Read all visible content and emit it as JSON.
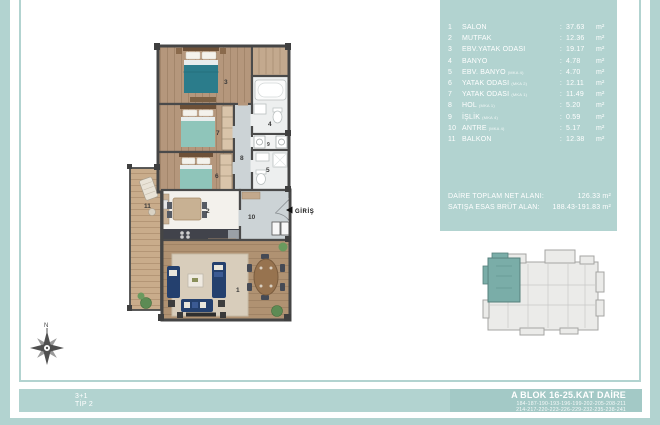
{
  "legend": {
    "separator": ":",
    "items": [
      {
        "num": "1",
        "name": "SALON",
        "suffix": "",
        "value": "37.63",
        "unit": "m²"
      },
      {
        "num": "2",
        "name": "MUTFAK",
        "suffix": "",
        "value": "12.36",
        "unit": "m²"
      },
      {
        "num": "3",
        "name": "EBV.YATAK ODASI",
        "suffix": "",
        "value": "19.17",
        "unit": "m²"
      },
      {
        "num": "4",
        "name": "BANYO",
        "suffix": "",
        "value": "4.78",
        "unit": "m²"
      },
      {
        "num": "5",
        "name": "EBV. BANYO",
        "suffix": "(MKA 4)",
        "value": "4.70",
        "unit": "m²"
      },
      {
        "num": "6",
        "name": "YATAK ODASI",
        "suffix": "(MKA 2)",
        "value": "12.11",
        "unit": "m²"
      },
      {
        "num": "7",
        "name": "YATAK ODASI",
        "suffix": "(MKA 1)",
        "value": "11.49",
        "unit": "m²"
      },
      {
        "num": "8",
        "name": "HOL",
        "suffix": "(MKA 1)",
        "value": "5.20",
        "unit": "m²"
      },
      {
        "num": "9",
        "name": "İŞLİK",
        "suffix": "(MKA 4)",
        "value": "0.59",
        "unit": "m²"
      },
      {
        "num": "10",
        "name": "ANTRE",
        "suffix": "(MKA 4)",
        "value": "5.17",
        "unit": "m²"
      },
      {
        "num": "11",
        "name": "BALKON",
        "suffix": "",
        "value": "12.38",
        "unit": "m²"
      }
    ]
  },
  "totals": {
    "net_label": "DAİRE TOPLAM NET ALANI:",
    "net_value": "126.33 m²",
    "gross_label": "SATIŞA ESAS BRÜT ALAN:",
    "gross_value": "188.43-191.83 m²"
  },
  "footer": {
    "type_line1": "3+1",
    "type_line2": "TİP 2",
    "block_title": "A BLOK 16-25.KAT DAİRE",
    "units_line1": "184-187-190-193-196-199-202-205-208-211",
    "units_line2": "214-217-220-223-226-229-232-235-238-241"
  },
  "plan": {
    "entrance_label": "GİRİŞ",
    "compass_label": "N",
    "numbers": {
      "salon": "1",
      "mutfak": "2",
      "ebv_yatak": "3",
      "banyo": "4",
      "ebv_banyo": "5",
      "yatak1": "6",
      "yatak2": "7",
      "hol": "8",
      "islik": "9",
      "antre": "10",
      "balkon": "11"
    }
  },
  "colors": {
    "teal_panel": "#b2d3d0",
    "teal_box": "#a3c9c6",
    "keyplan_unit": "#7aada8",
    "bed_master": "#2b7c8b",
    "bed_guest": "#8fc5ba",
    "sofa": "#24406e"
  }
}
